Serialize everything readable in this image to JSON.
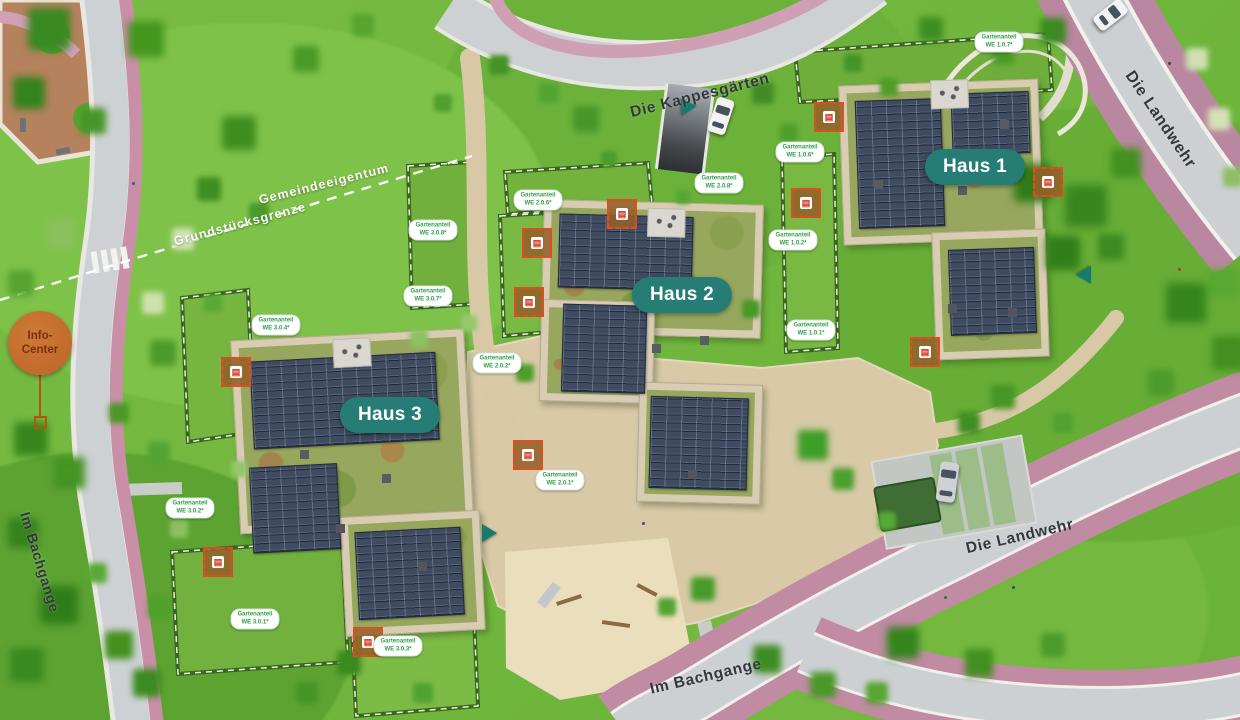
{
  "plan": {
    "buildings": [
      {
        "label": "Haus 1"
      },
      {
        "label": "Haus 2"
      },
      {
        "label": "Haus 3"
      }
    ],
    "streets": {
      "kappesgaerten": "Die Kappesgärten",
      "landwehr_top": "Die Landwehr",
      "landwehr_mid": "Die Landwehr",
      "bachgange_left": "Im Bachgange",
      "bachgange_bottom": "Im Bachgange"
    },
    "boundaries": [
      {
        "label": "Gemeindeeigentum"
      },
      {
        "label": "Grundstücksgrenze"
      }
    ],
    "info_center": {
      "line1": "Info-",
      "line2": "Center"
    },
    "garden_tags": [
      {
        "line1": "Gartenanteil",
        "line2": "WE 1.0.7*"
      },
      {
        "line1": "Gartenanteil",
        "line2": "WE 1.0.6*"
      },
      {
        "line1": "Gartenanteil",
        "line2": "WE 2.0.8*"
      },
      {
        "line1": "Gartenanteil",
        "line2": "WE 1.0.2*"
      },
      {
        "line1": "Gartenanteil",
        "line2": "WE 1.0.1*"
      },
      {
        "line1": "Gartenanteil",
        "line2": "WE 2.0.6*"
      },
      {
        "line1": "Gartenanteil",
        "line2": "WE 3.0.8*"
      },
      {
        "line1": "Gartenanteil",
        "line2": "WE 3.0.7*"
      },
      {
        "line1": "Gartenanteil",
        "line2": "WE 2.0.2*"
      },
      {
        "line1": "Gartenanteil",
        "line2": "WE 2.0.1*"
      },
      {
        "line1": "Gartenanteil",
        "line2": "WE 3.0.4*"
      },
      {
        "line1": "Gartenanteil",
        "line2": "WE 3.0.2*"
      },
      {
        "line1": "Gartenanteil",
        "line2": "WE 3.0.1*"
      },
      {
        "line1": "Gartenanteil",
        "line2": "WE 3.0.3*"
      }
    ],
    "icons": {
      "marker_glyph": "▤"
    },
    "colors": {
      "accent_teal": "#267D76",
      "garden_label_green": "#2F9E47",
      "info_orange": "#BD6526",
      "marker_red": "#E8491D",
      "bike_lane_pink": "#C08BA3",
      "road_gray": "#CDD1D3",
      "solar_blue": "#3E4B61",
      "courtyard_beige": "#D9C9A7"
    }
  }
}
